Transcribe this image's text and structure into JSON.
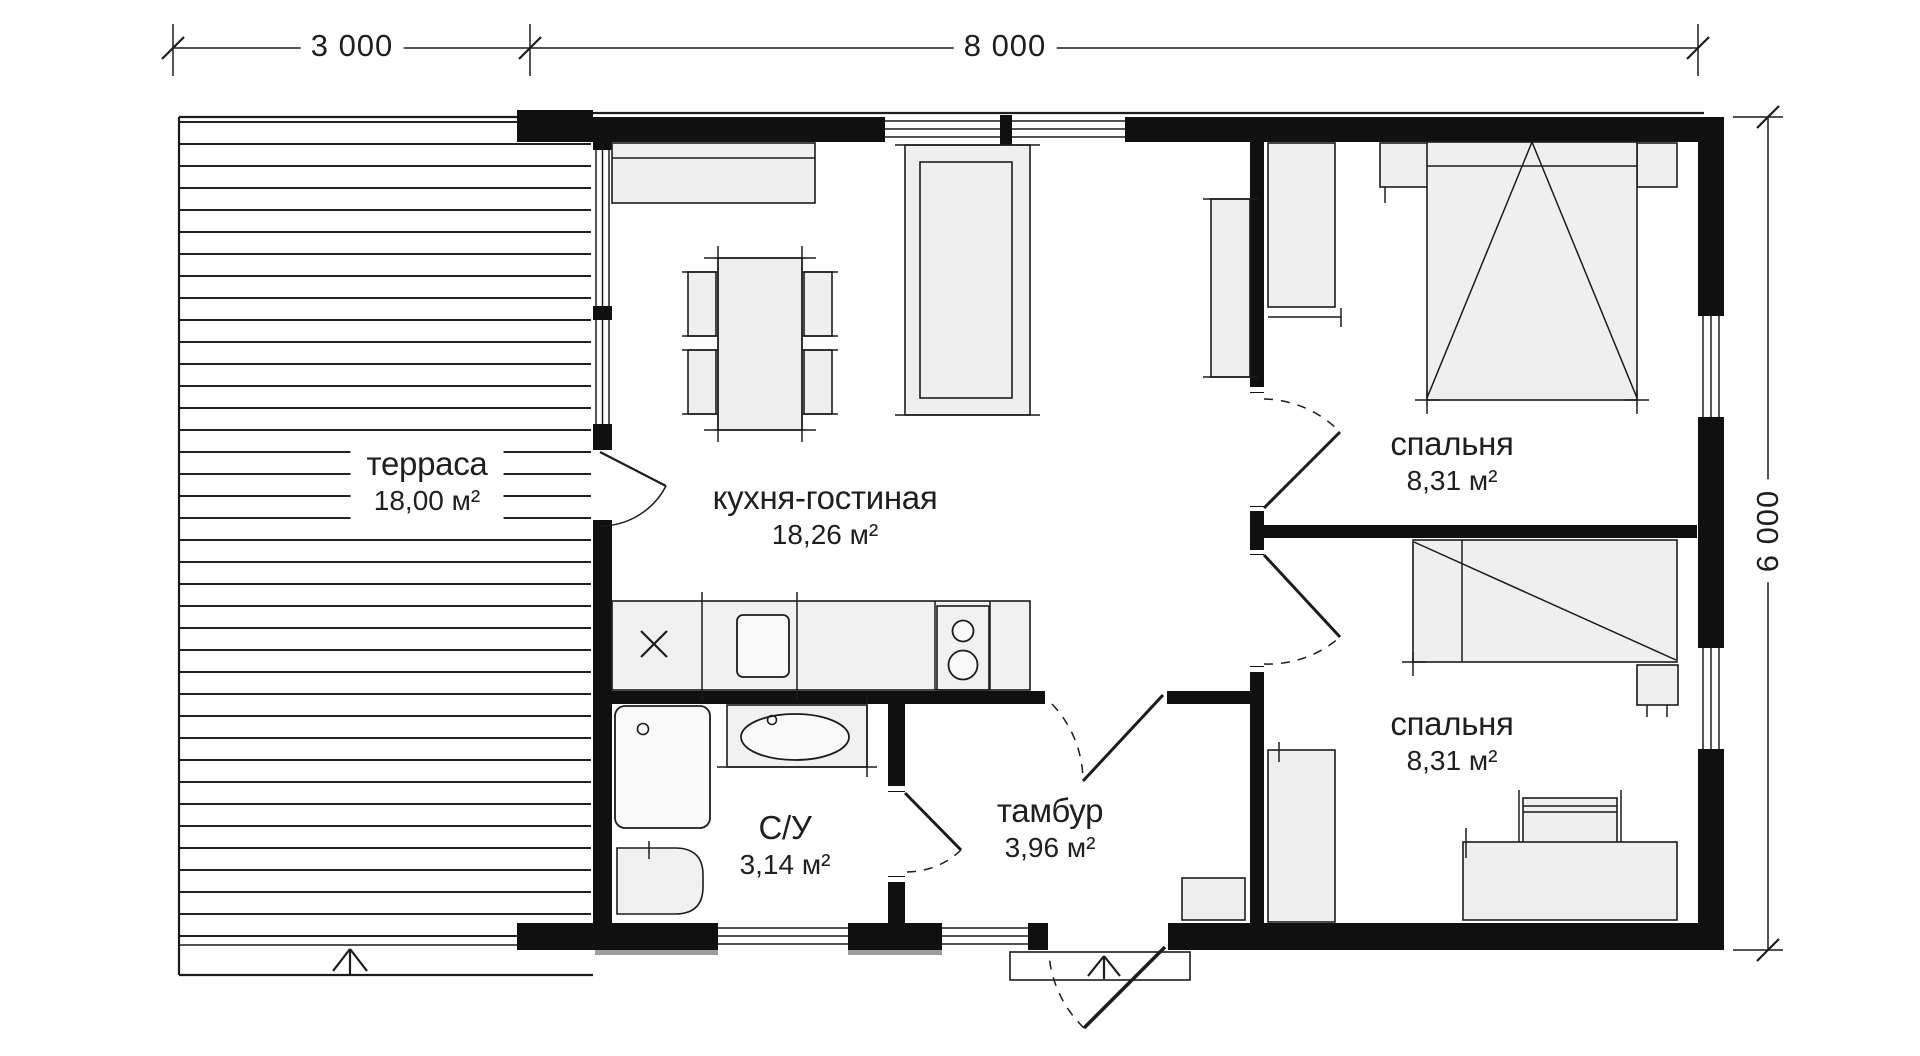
{
  "dimensions": {
    "top": [
      {
        "label": "3 000"
      },
      {
        "label": "8 000"
      }
    ],
    "right": {
      "label": "6 000"
    }
  },
  "rooms": {
    "terrace": {
      "name": "терраса",
      "area": "18,00 м²"
    },
    "kitchen_living": {
      "name": "кухня-гостиная",
      "area": "18,26 м²"
    },
    "bathroom": {
      "name": "С/У",
      "area": "3,14 м²"
    },
    "vestibule": {
      "name": "тамбур",
      "area": "3,96 м²"
    },
    "bedroom_top": {
      "name": "спальня",
      "area": "8,31 м²"
    },
    "bedroom_bottom": {
      "name": "спальня",
      "area": "8,31 м²"
    }
  },
  "icons": {
    "entry_arrow": "up-arrow entrance marker",
    "sink_cross": "x",
    "door_arc": "quarter-circle swing"
  },
  "colors": {
    "wall": "#101010",
    "line": "#1c1c1c",
    "furniture_fill": "#efefef",
    "paper": "#ffffff",
    "text": "#1f1f1f",
    "shadow": "#9e9e9e",
    "accent_gray": "#f1f1f1"
  }
}
